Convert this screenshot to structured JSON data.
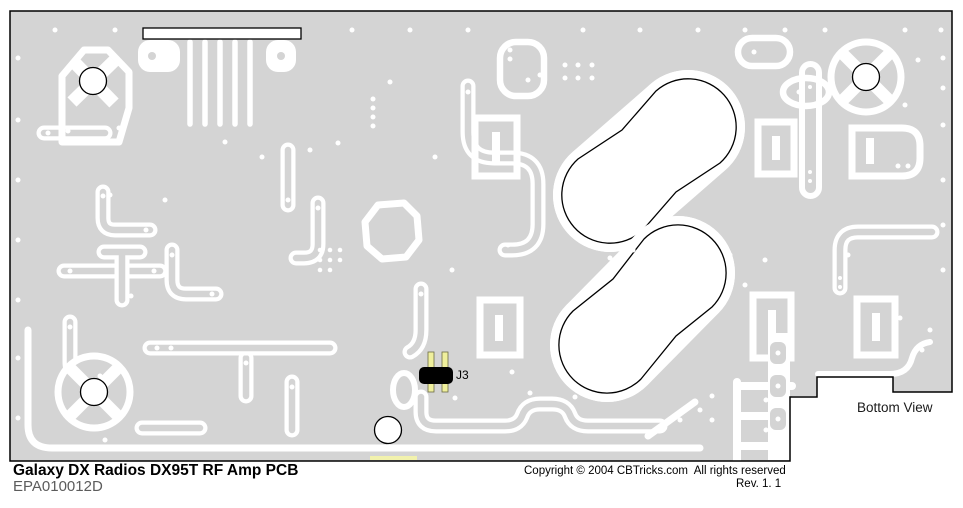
{
  "pcb": {
    "title": "Galaxy DX Radios DX95T RF Amp PCB",
    "part_number": "EPA010012D",
    "copyright": "Copyright © 2004 CBTricks.com  All rights reserved",
    "revision": "Rev. 1. 1",
    "view_label": "Bottom View",
    "components": [
      {
        "ref": "J3",
        "type": "2-pin jumper"
      }
    ],
    "colors": {
      "board": "#d4d4d4",
      "trace": "#ffffff",
      "outline": "#000000",
      "hole_fill": "#ffffff",
      "jumper_body": "#000000",
      "jumper_pin": "#efef9c",
      "highlight": "#f2f2ad",
      "part_number_text": "#5c5c5c",
      "background": "#ffffff"
    }
  }
}
